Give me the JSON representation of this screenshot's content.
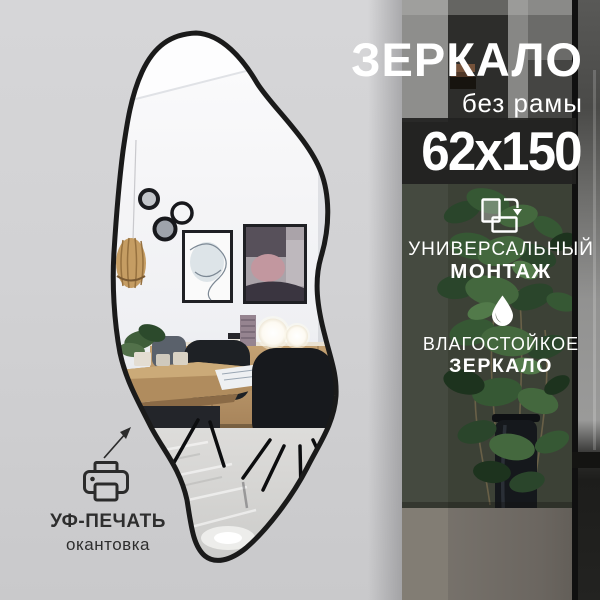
{
  "card": {
    "title": "ЗЕРКАЛО",
    "subtitle": "без рамы",
    "dimensions": "62x150",
    "features": [
      {
        "icon": "rotate-orientation-icon",
        "line1": "УНИВЕРСАЛЬНЫЙ",
        "line2": "МОНТАЖ"
      },
      {
        "icon": "water-drop-icon",
        "line1": "ВЛАГОСТОЙКОЕ",
        "line2": "ЗЕРКАЛО"
      }
    ],
    "print_feature": {
      "icon": "printer-icon",
      "line1": "УФ-ПЕЧАТЬ",
      "line2": "окантовка"
    }
  },
  "colors": {
    "background": "#d2d2d4",
    "size_band": "#212120",
    "text_light": "#ffffff",
    "text_dark": "#2e2e2e",
    "mirror_frame": "#1a1a1a",
    "plant_green": "#3a5c38",
    "wood": "#b5905f"
  }
}
